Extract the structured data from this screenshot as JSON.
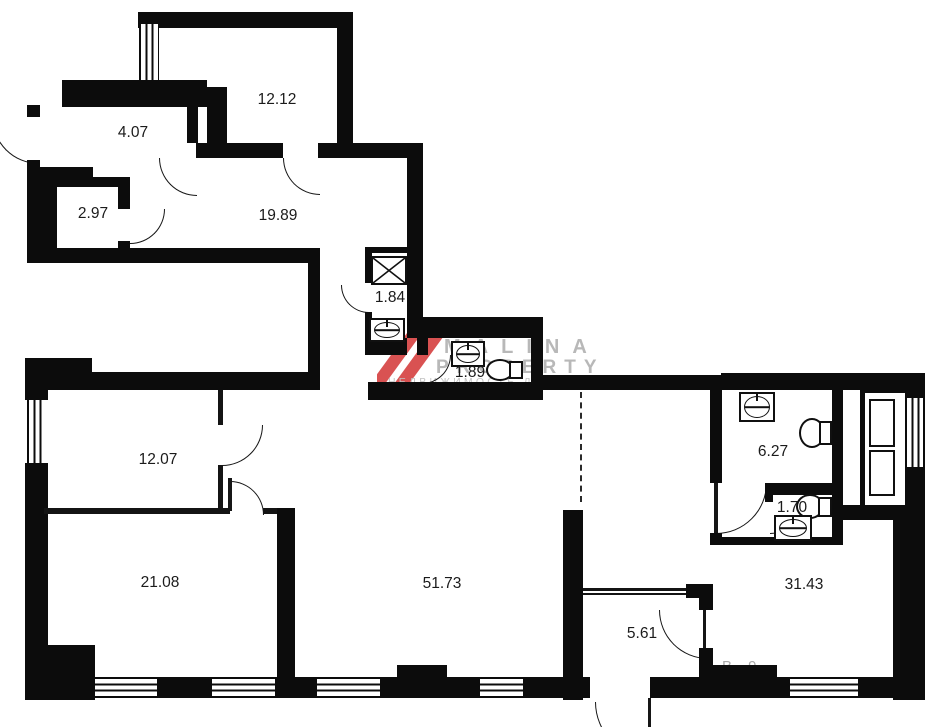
{
  "plan": {
    "title": "apartment floor plan",
    "rooms": [
      {
        "id": "room-top-bedroom",
        "area": "12.12"
      },
      {
        "id": "room-entry-hall",
        "area": "4.07"
      },
      {
        "id": "room-storage",
        "area": "2.97"
      },
      {
        "id": "room-upper-hall",
        "area": "19.89"
      },
      {
        "id": "room-shaft-closet",
        "area": "1.84"
      },
      {
        "id": "room-upper-wc",
        "area": "1.89"
      },
      {
        "id": "room-12-07",
        "area": "12.07"
      },
      {
        "id": "room-21-08",
        "area": "21.08"
      },
      {
        "id": "room-living",
        "area": "51.73"
      },
      {
        "id": "room-5-61",
        "area": "5.61"
      },
      {
        "id": "room-31-43",
        "area": "31.43"
      },
      {
        "id": "room-bathroom",
        "area": "6.27"
      },
      {
        "id": "room-wc-small",
        "area": "1.70"
      }
    ],
    "watermark": {
      "brand_top": "MALINA",
      "brand_bottom": "PROPERTY",
      "tagline": "НЕДВИЖИМОСТЬ ДЛЯ БИЗНЕСА",
      "fragment": "В 9",
      "accent_color": "#d95252",
      "text_color": "#b8b8b8"
    },
    "colors": {
      "wall": "#0c0c0c",
      "background": "#ffffff",
      "dashed_line": "#2a2a2a"
    },
    "fixtures": [
      "ventilation-shaft",
      "sink",
      "toilet",
      "elevator-doors",
      "window"
    ]
  }
}
